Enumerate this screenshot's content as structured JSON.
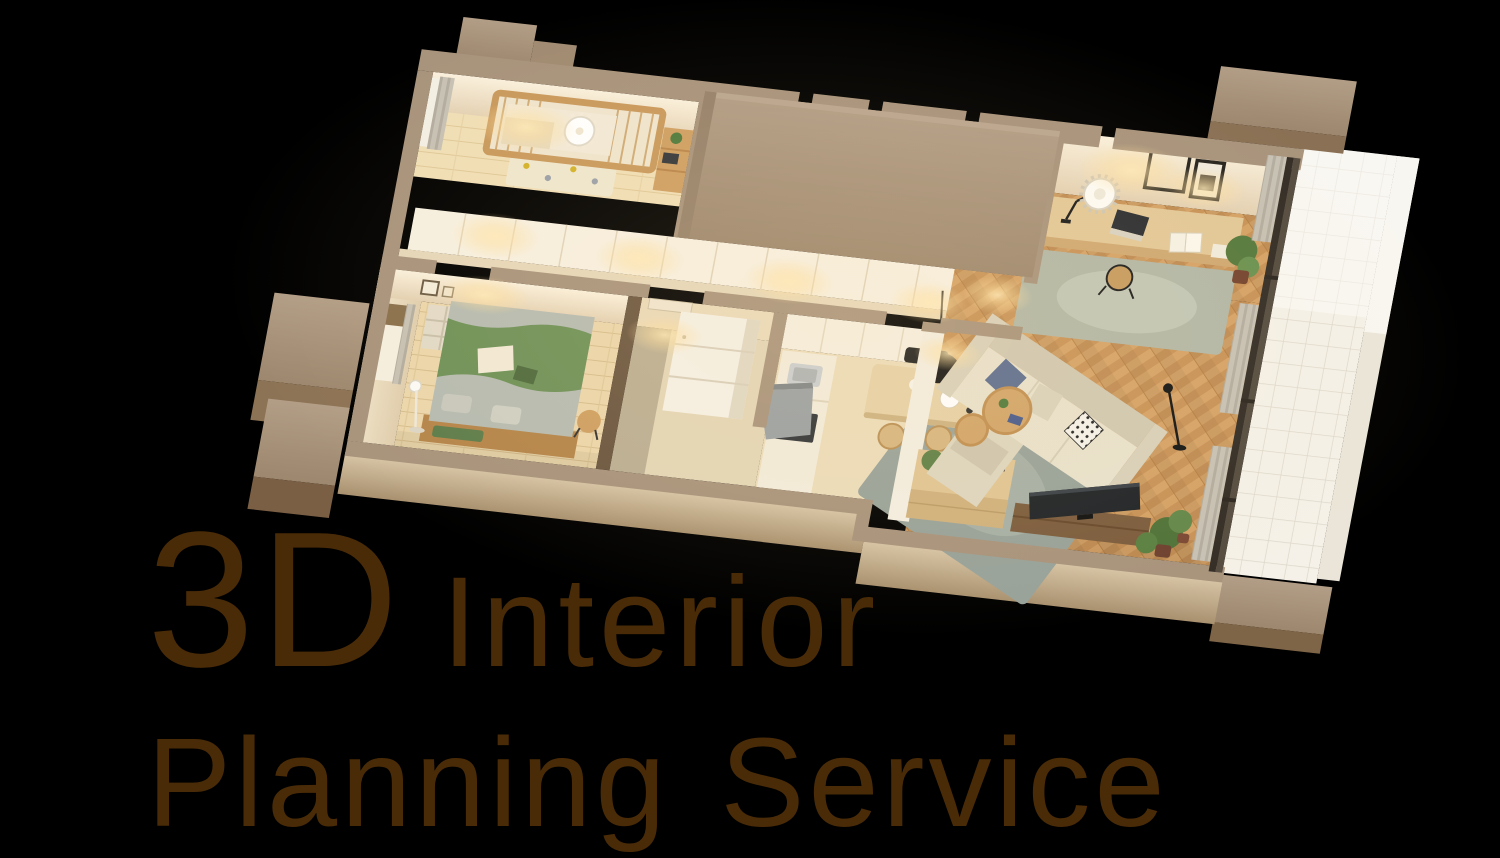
{
  "page": {
    "width": 1500,
    "height": 858,
    "background_color": "#000000"
  },
  "hero": {
    "line1_big": "3D",
    "line1_small": "Interior",
    "line2": "Planning Service",
    "text_color": "#4a2b07"
  },
  "scene": {
    "description": "Cutaway isometric 3D render of a furnished apartment with balcony, warm evening lighting",
    "palette": {
      "background": "#000000",
      "text_brown": "#4a2b07",
      "wall_top_tan": "#a8937c",
      "wall_tan_dark": "#8a7054",
      "wall_face_beige": "#f6ead4",
      "floor_wood_light": "#ebd6ab",
      "parquet_wood": "#cf9a5e",
      "white_cabinet": "#f6efe1",
      "sofa_beige": "#e7e0cb",
      "rug_gray_green": "#98a29a",
      "bed_green": "#6e9158",
      "mattress_gray": "#b6bbb1",
      "furniture_wood": "#d9b988",
      "crib_wood": "#c9995c",
      "plant_green": "#55793d",
      "accent_black": "#161616",
      "balcony_tile": "#f5f1e8",
      "warm_glow": "#ffdf9e"
    },
    "rooms": [
      {
        "name": "kids room",
        "items": [
          "crib",
          "round ceiling light",
          "wall shelf",
          "window curtain",
          "dotted play mat"
        ]
      },
      {
        "name": "closet corridor",
        "items": [
          "built-in wardrobes",
          "warm downlights"
        ]
      },
      {
        "name": "enclosed service block",
        "items": [
          "closed ceiling"
        ]
      },
      {
        "name": "bedroom",
        "items": [
          "double bed with green blanket",
          "pillows",
          "floor lamp",
          "side table",
          "open shelf",
          "window with blind"
        ]
      },
      {
        "name": "hall",
        "items": [
          "door",
          "refrigerator"
        ]
      },
      {
        "name": "kitchen",
        "items": [
          "counter with sink",
          "cooktop",
          "range hood",
          "white panel wall"
        ]
      },
      {
        "name": "living dining",
        "items": [
          "desk",
          "desk lamp",
          "round pendant light",
          "laptop",
          "picture frames",
          "dining table",
          "black pendant lamp",
          "chairs",
          "island sideboard",
          "L-shaped sofa",
          "navy cushion",
          "patterned cushion",
          "round coffee tables",
          "gray rug",
          "TV on low board",
          "potted plants",
          "black floor lamp"
        ]
      },
      {
        "name": "balcony",
        "items": [
          "white tile floor",
          "concrete parapet blocks"
        ]
      }
    ]
  }
}
